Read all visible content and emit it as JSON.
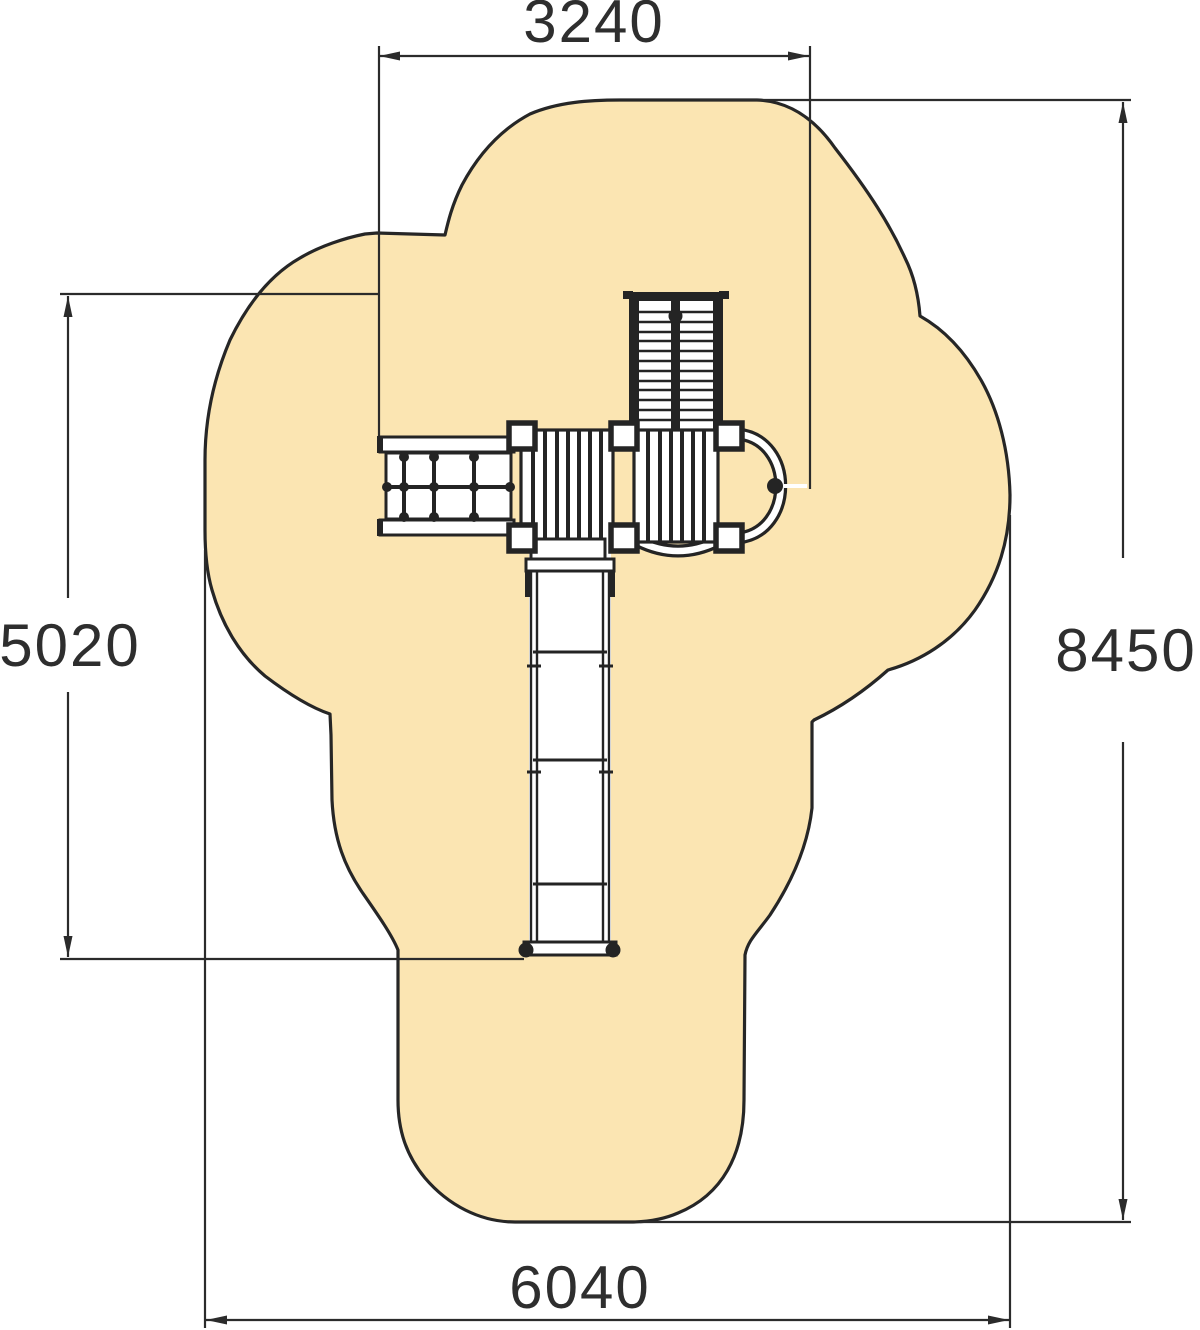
{
  "drawing": {
    "dimension_labels": {
      "width_top": "3240",
      "height_left": "5020",
      "height_right": "8450",
      "width_bottom": "6040"
    },
    "colors": {
      "safety_zone_fill": "#FBE5B2",
      "outline": "#262626",
      "dimension_line": "#2B2B2B",
      "label_text": "#2E2E2E"
    }
  }
}
